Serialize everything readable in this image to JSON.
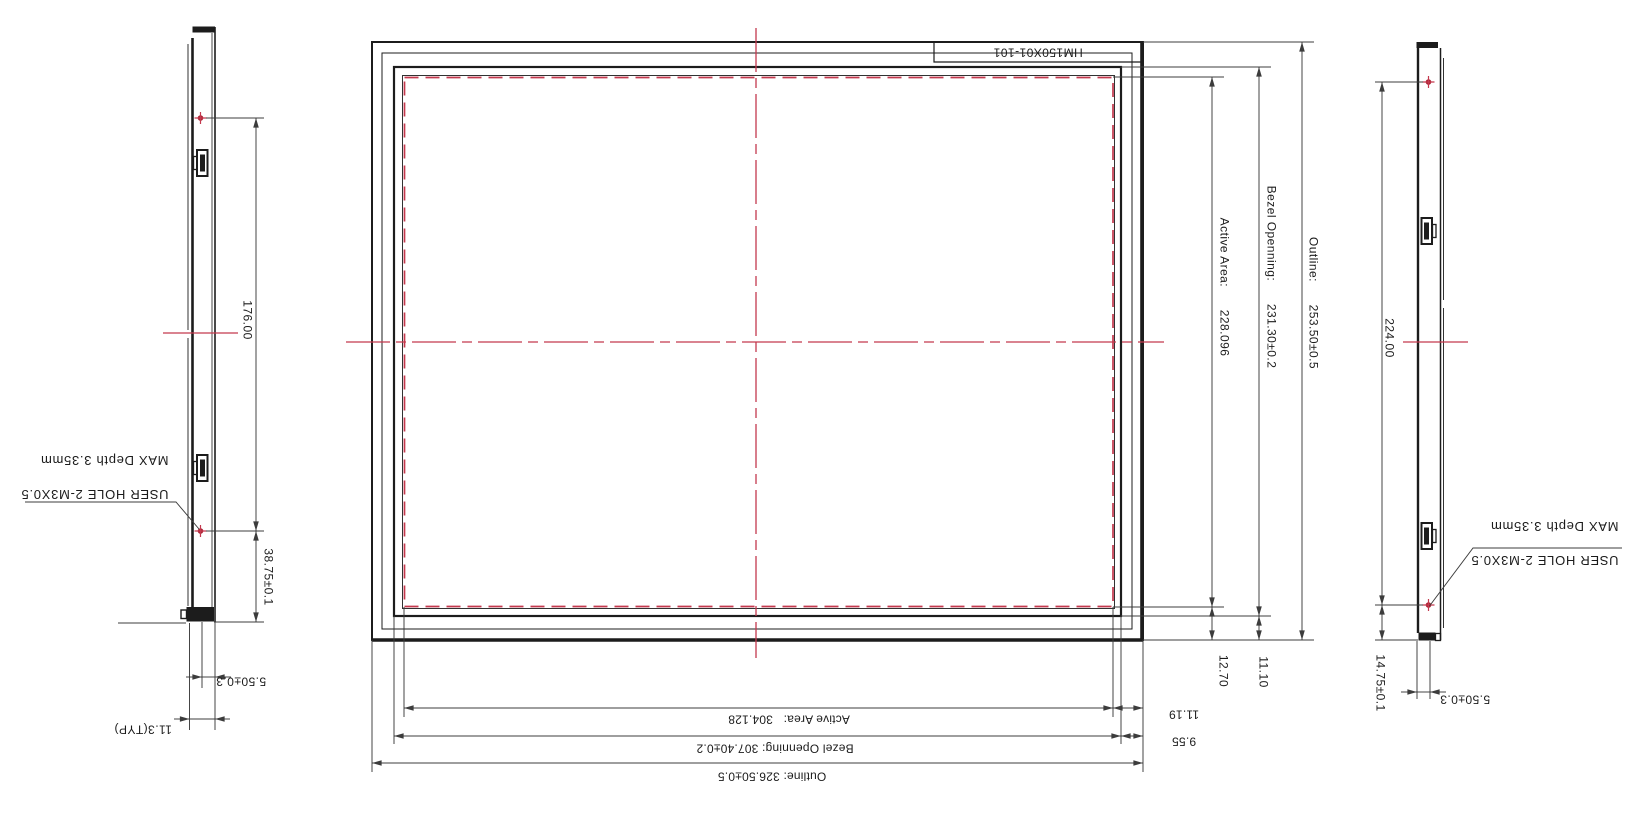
{
  "front_view": {
    "part_label": "HM150X01-101",
    "side_dims": {
      "active": "Active Area:      228.096",
      "bezel": "Bezel Openning:      231.30±0.2",
      "outline": "Outline:      253.50±0.5",
      "active_to_edge": "12.70",
      "bezel_to_edge": "11.10"
    },
    "bottom_dims": {
      "active": "Active Area:   304.128",
      "bezel": "Bezel Openning: 307.40±0.2",
      "outline": "Outline: 326.50±0.5",
      "active_to_edge": "11.19",
      "bezel_to_edge": "9.55"
    }
  },
  "left_side_view": {
    "hole_pitch": "176.00",
    "hole_to_bottom": "38.75±0.1",
    "front_thickness": "5.50±0.3",
    "total_thickness": "11.3(TYP)",
    "user_hole_note_line1": "USER HOLE 2-M3X0.5",
    "user_hole_note_line2": "MAX Depth 3.35mm"
  },
  "right_side_view": {
    "hole_pitch": "224.00",
    "hole_to_bottom": "14.75±0.1",
    "front_thickness": "5.50±0.3",
    "user_hole_note_line1": "USER HOLE 2-M3X0.5",
    "user_hole_note_line2": "MAX Depth 3.35mm"
  },
  "colors": {
    "line": "#1c1c1c",
    "dim": "#3c3c3c",
    "text": "#1b1b1b",
    "centerline": "#c4394e",
    "hole": "#aa2233",
    "background": "#ffffff"
  }
}
